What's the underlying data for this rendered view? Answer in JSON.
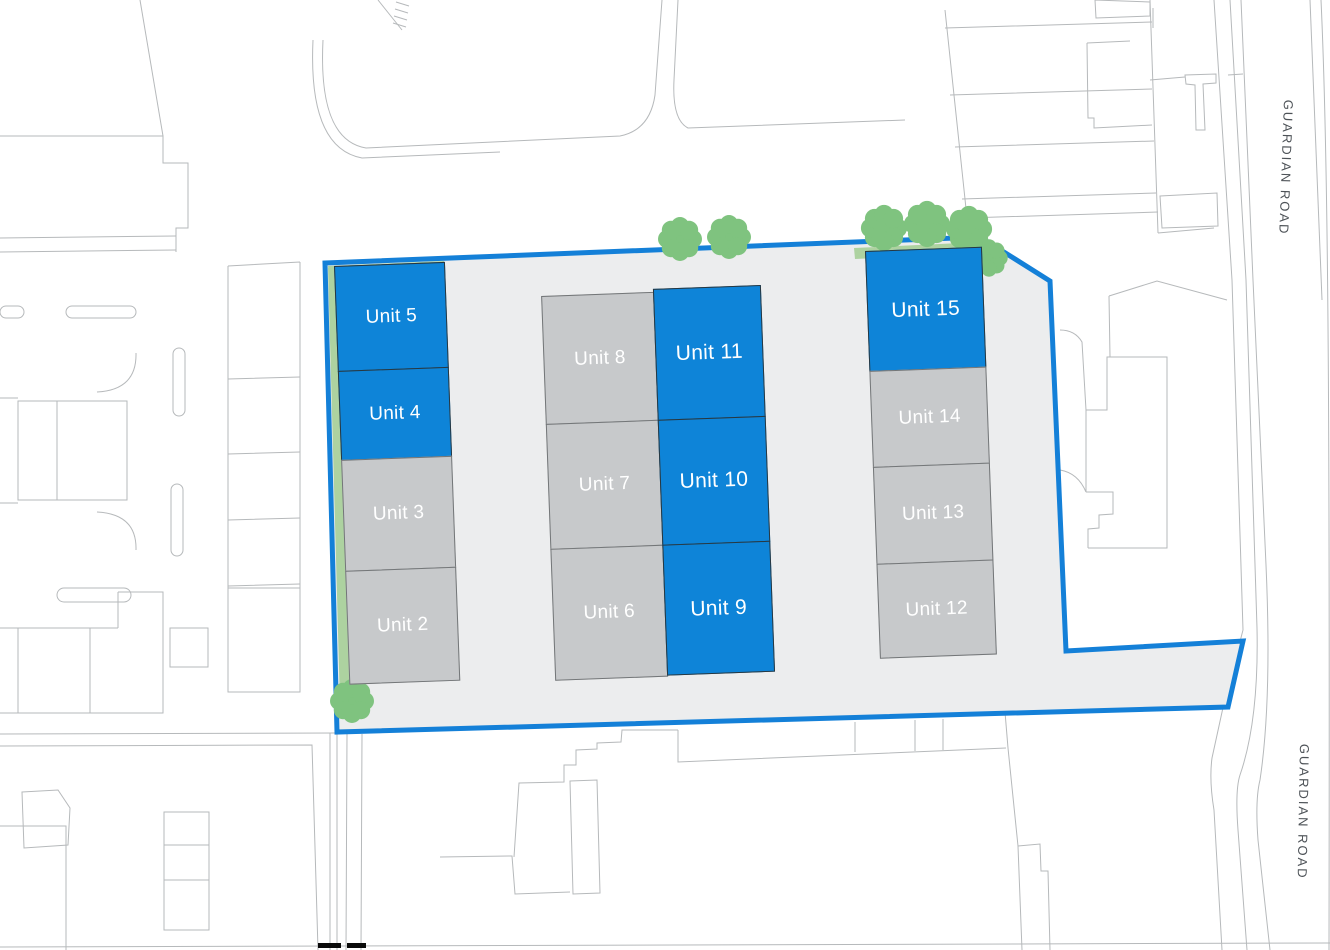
{
  "site_plan": {
    "roads": [
      {
        "label": "GUARDIAN ROAD"
      },
      {
        "label": "GUARDIAN ROAD"
      }
    ],
    "unit_groups": {
      "west_terrace": [
        {
          "label": "Unit 5",
          "variant": "blue"
        },
        {
          "label": "Unit 4",
          "variant": "blue"
        },
        {
          "label": "Unit 3",
          "variant": "grey"
        },
        {
          "label": "Unit 2",
          "variant": "grey"
        }
      ],
      "central_terrace_west": [
        {
          "label": "Unit 8",
          "variant": "grey"
        },
        {
          "label": "Unit 7",
          "variant": "grey"
        },
        {
          "label": "Unit 6",
          "variant": "grey"
        }
      ],
      "central_terrace_east": [
        {
          "label": "Unit 11",
          "variant": "blue"
        },
        {
          "label": "Unit 10",
          "variant": "blue"
        },
        {
          "label": "Unit 9",
          "variant": "blue"
        }
      ],
      "east_terrace": [
        {
          "label": "Unit 15",
          "variant": "blue"
        },
        {
          "label": "Unit 14",
          "variant": "grey"
        },
        {
          "label": "Unit 13",
          "variant": "grey"
        },
        {
          "label": "Unit 12",
          "variant": "grey"
        }
      ]
    },
    "colors": {
      "unit_blue": "#0E84D8",
      "unit_grey": "#C7C9CB",
      "site_boundary_blue": "#1480D8",
      "site_fill": "#ECEDEE",
      "landscaping_green": "#ADD2A0",
      "tree_green": "#7FC37F",
      "background_line_grey": "#B6B9BB"
    }
  }
}
